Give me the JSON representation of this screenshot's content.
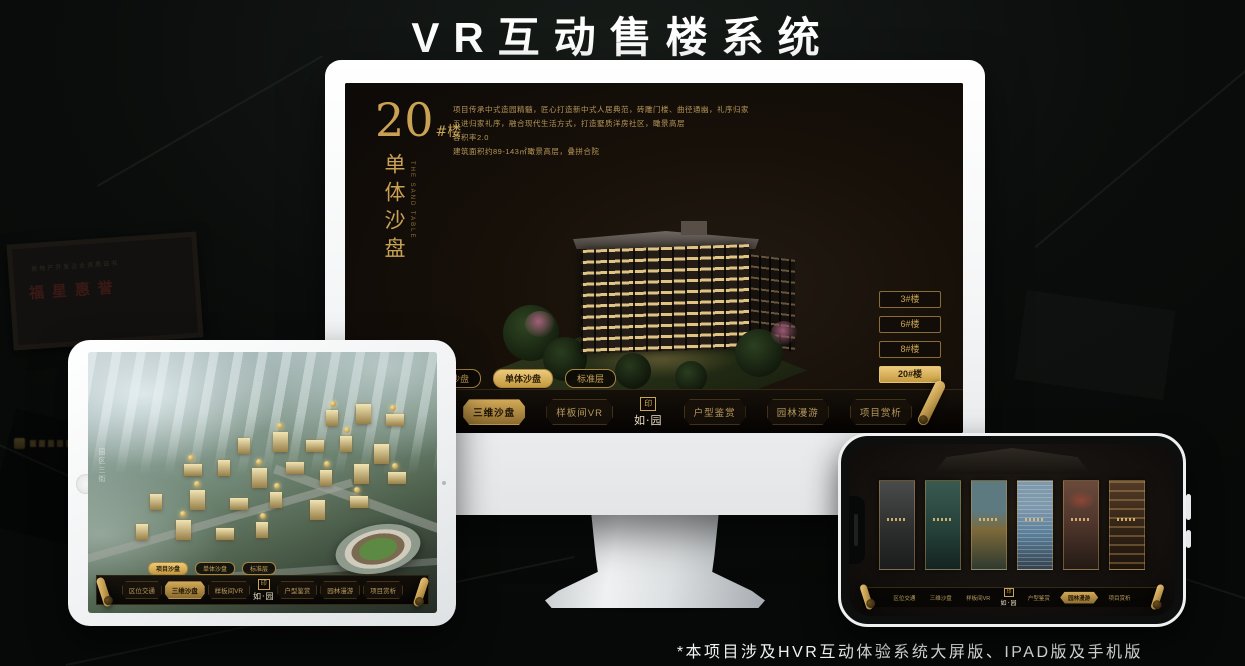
{
  "page": {
    "title": "VR互动售楼系统",
    "footnote": "*本项目涉及HVR互动体验系统大屏版、IPAD版及手机版"
  },
  "colors": {
    "gold": "#c9a254",
    "gold_active": "#ecca7c",
    "nav_text": "#b79a5e",
    "screen_bg": "#17110c"
  },
  "brand": {
    "logo_text": "如·园",
    "seal_glyph": "印"
  },
  "background": {
    "plaque_text": "福星惠誉",
    "plaque_subtext": "房地产开发企业资质证书"
  },
  "app": {
    "building_title": {
      "number": "20",
      "suffix": "#楼",
      "vertical": "单体沙盘",
      "vertical_en": "THE SAND TABLE"
    },
    "description_lines": [
      "项目传承中式造园精髓，匠心打造新中式人居典范，砖雕门楼、曲径通幽，礼序归家",
      "五进归家礼序，融合现代生活方式，打造墅质洋房社区，瞰景高层",
      "容积率2.0",
      "建筑面积约89-143㎡瞰景高层，叠拼合院"
    ],
    "floor_buttons": [
      {
        "label": "3#楼",
        "active": false
      },
      {
        "label": "6#楼",
        "active": false
      },
      {
        "label": "8#楼",
        "active": false
      },
      {
        "label": "20#楼",
        "active": true
      }
    ],
    "sub_tabs": [
      {
        "label": "项目沙盘"
      },
      {
        "label": "单体沙盘"
      },
      {
        "label": "标准层"
      }
    ],
    "nav_items": [
      {
        "label": "区位交通"
      },
      {
        "label": "三维沙盘"
      },
      {
        "label": "样板间VR"
      },
      {
        "label": "户型鉴赏"
      },
      {
        "label": "园林漫游"
      },
      {
        "label": "项目赏析"
      }
    ]
  },
  "monitor": {
    "active_sub_tab": "单体沙盘",
    "active_nav": "三维沙盘"
  },
  "ipad": {
    "active_sub_tab": "项目沙盘",
    "active_nav": "三维沙盘",
    "road_label": "园区三街"
  },
  "phone": {
    "active_nav": "园林漫游",
    "panel_count": 6
  }
}
